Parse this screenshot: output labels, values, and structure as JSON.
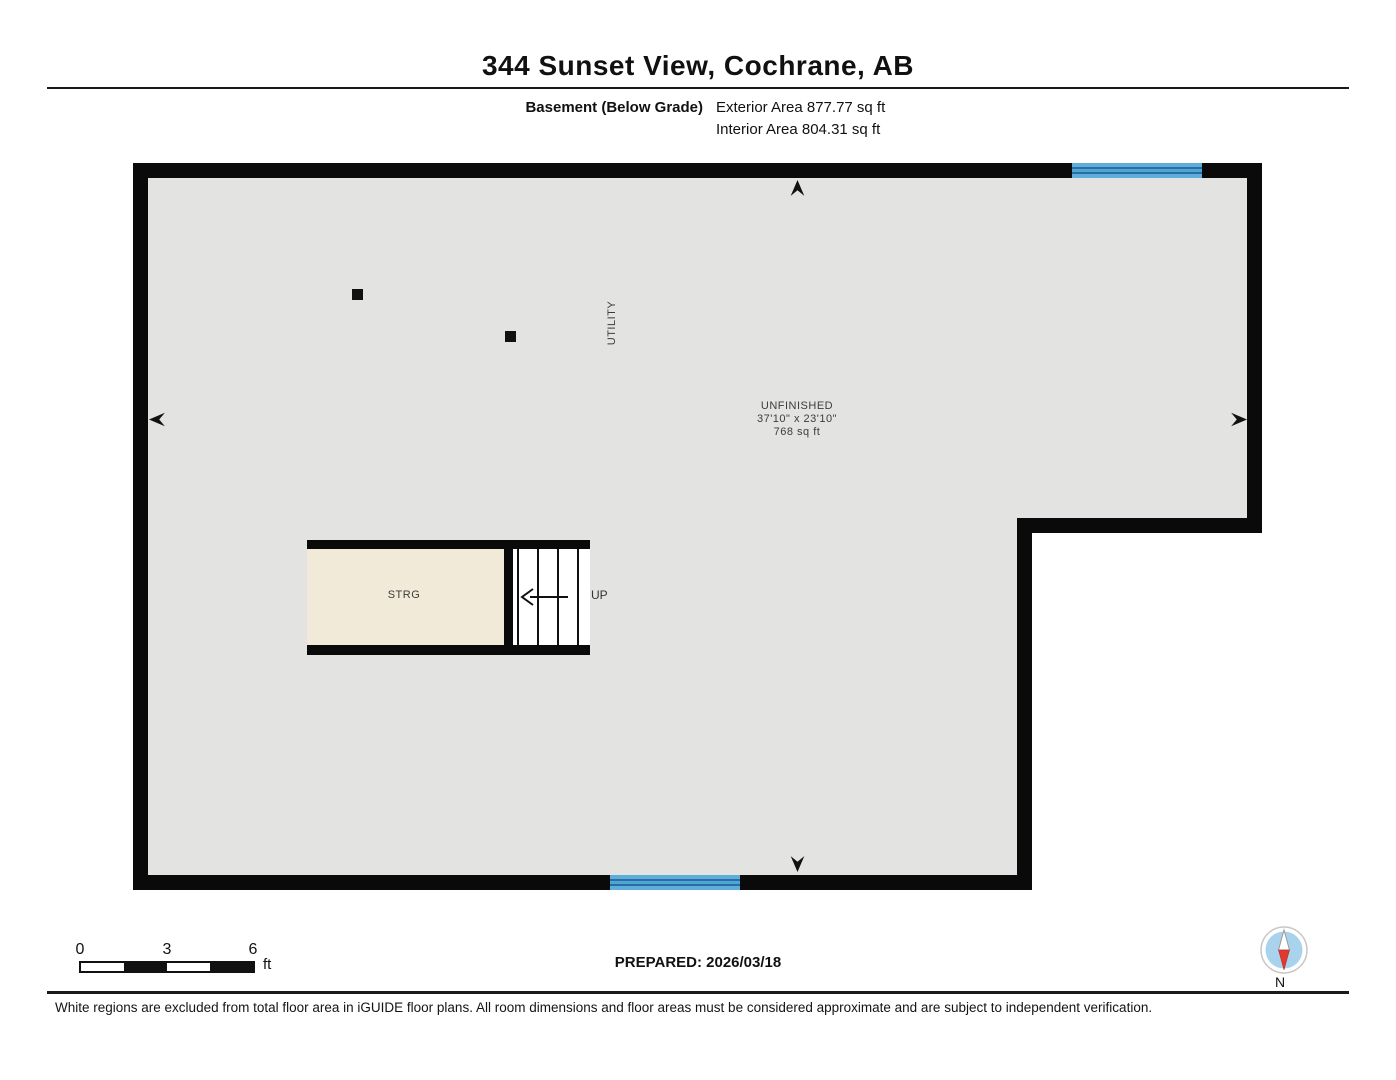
{
  "header": {
    "title": "344 Sunset View, Cochrane, AB",
    "floor_label": "Basement (Below Grade)",
    "exterior_area": "Exterior Area 877.77 sq ft",
    "interior_area": "Interior Area 804.31 sq ft"
  },
  "floorplan": {
    "unfinished": {
      "name": "UNFINISHED",
      "dims": "37'10\" x 23'10\"",
      "area": "768 sq ft"
    },
    "utility_label": "UTILITY",
    "storage_label": "STRG",
    "stairs_up_label": "UP",
    "colors": {
      "wall": "#0a0a0a",
      "interior": "#e3e3e1",
      "storage_fill": "#f2ead9",
      "window_blue": "#5fadd9",
      "window_stripe": "#2a6da5"
    }
  },
  "footer": {
    "scale": {
      "t0": "0",
      "t3": "3",
      "t6": "6",
      "unit": "ft"
    },
    "prepared": "PREPARED: 2026/03/18",
    "compass_label": "N",
    "compass_colors": {
      "disc": "#a9d2ec",
      "needle_south": "#e03a2f"
    },
    "disclaimer": "White regions are excluded from total floor area in iGUIDE floor plans. All room dimensions and floor areas must be considered approximate and are subject to independent verification."
  }
}
